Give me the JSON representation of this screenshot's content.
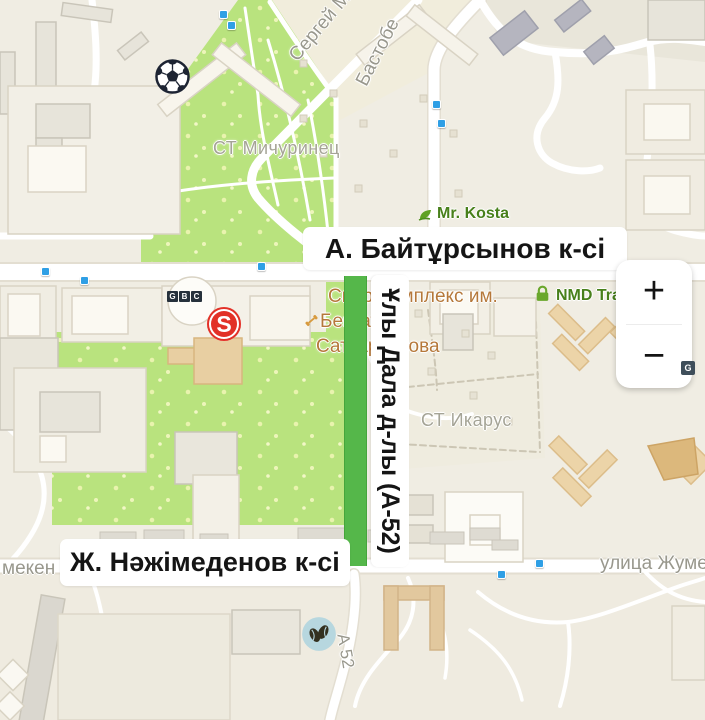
{
  "streets": {
    "baytursynov": "А. Байтұрсынов к-сі",
    "nazhimedenov": "Ж. Нәжімеденов к-сі",
    "uly_dala": "Ұлы Дала д-лы (А-52)",
    "bastobe": "Бастобе",
    "sergey_mar": "Сергей Мар",
    "zhumeken": "улица Жумекен",
    "zhumeken_partial": "мекен Н",
    "a52": "А 52"
  },
  "areas": {
    "michurinets": "СТ Мичуринец",
    "ikarus": "СТ Икарус"
  },
  "pois": {
    "mr_kosta": "Mr. Kosta",
    "nmd": "NMD Tra",
    "sport_complex": {
      "line1": "Спорткомплекс им.",
      "line2": "Бекзата",
      "line3": "Саттарханова"
    },
    "gbc_letters": [
      "G",
      "B",
      "C"
    ],
    "s_badge": "S",
    "g_badge": "G"
  },
  "controls": {
    "zoom_in": "+",
    "zoom_out": "−"
  },
  "icons": {
    "football": "football-icon",
    "coffee": "coffee-beans-icon",
    "padlock": "padlock-icon",
    "leaf": "leaf-icon",
    "dumbbell": "dumbbell-icon"
  },
  "colors": {
    "park": "#b9e37e",
    "highlighted_road": "#55b74a",
    "transit_stop": "#2f9fe5",
    "poi_green": "#48801b",
    "poi_orange": "#b5783a",
    "s_badge_red": "#e23127",
    "badge_dark": "#26313c"
  }
}
